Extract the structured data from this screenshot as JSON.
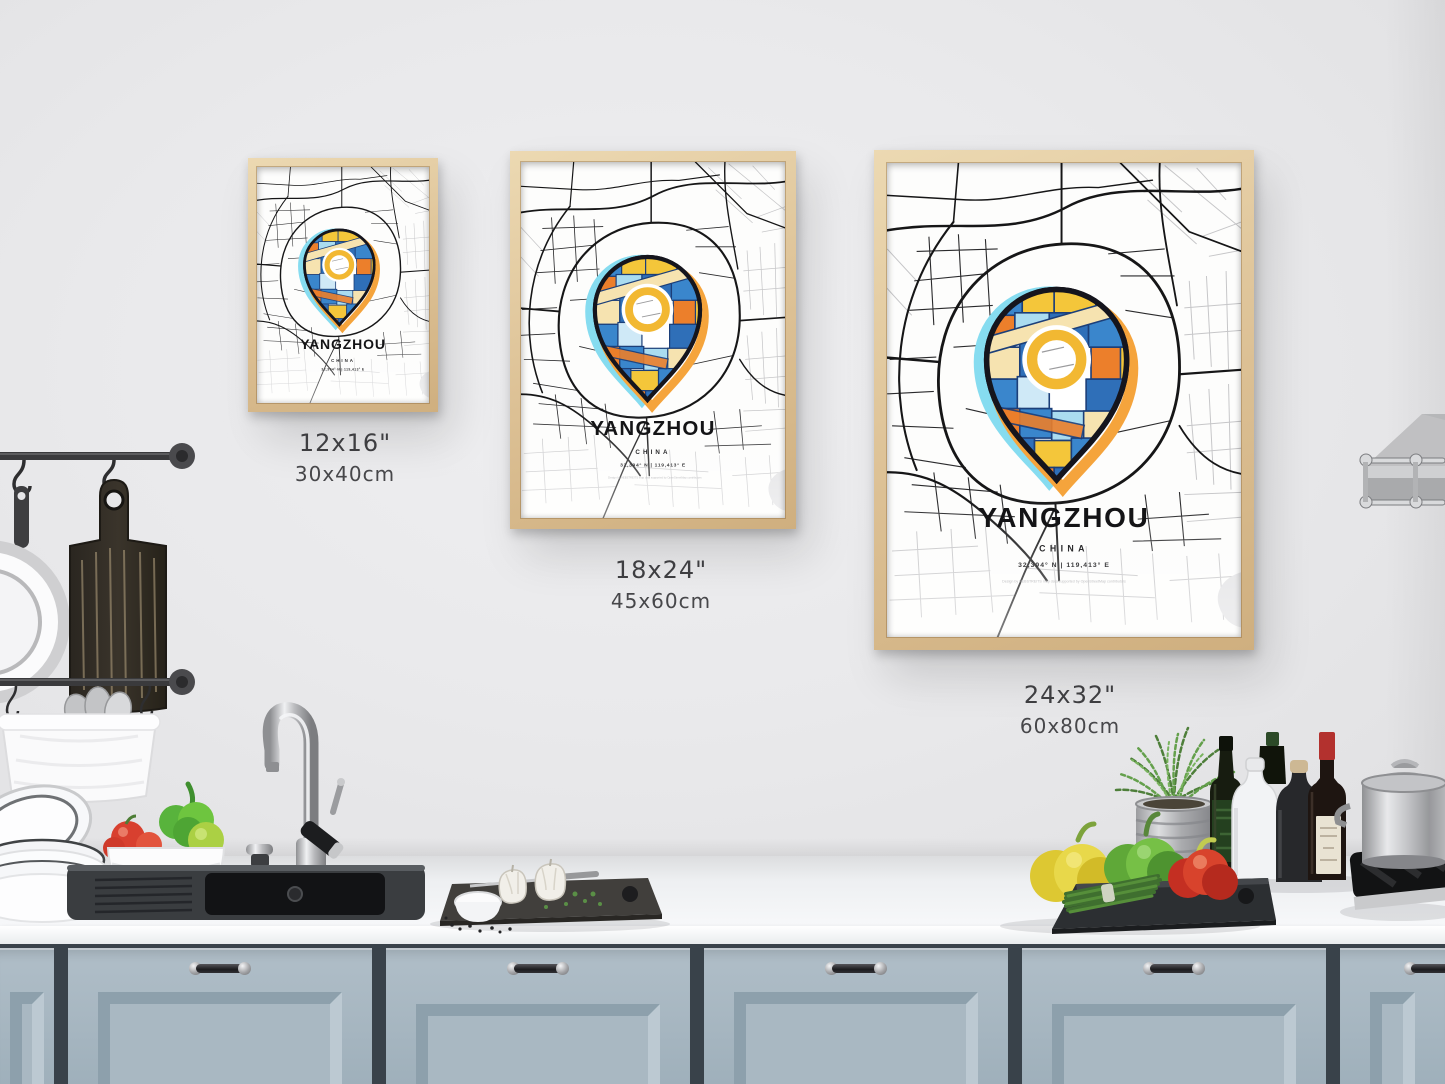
{
  "poster": {
    "title": "YANGZHOU",
    "country": "CHINA",
    "coordinates": "32,394° N | 119,413° E",
    "attribution": "Design by HEBSTREITS   map data supported by OpenStreetMap contributors"
  },
  "sizes": [
    {
      "inches": "12x16\"",
      "cm": "30x40cm"
    },
    {
      "inches": "18x24\"",
      "cm": "45x60cm"
    },
    {
      "inches": "24x32\"",
      "cm": "60x80cm"
    }
  ],
  "colors": {
    "frame_wood": "#dcc094",
    "cabinet_blue_gray": "#a7b6c0",
    "pin_blue": "#2f6fb8",
    "pin_light_blue": "#aadcf0",
    "pin_orange": "#ec7f2b",
    "pin_yellow": "#f4c63a",
    "pin_cream": "#f6e3b0",
    "ring_yellow": "#f2b832",
    "glow_cyan": "#86dcf0",
    "glow_orange": "#f5a43c",
    "map_street_black": "#1a1a1c",
    "map_street_gray": "#c2c2c4"
  }
}
